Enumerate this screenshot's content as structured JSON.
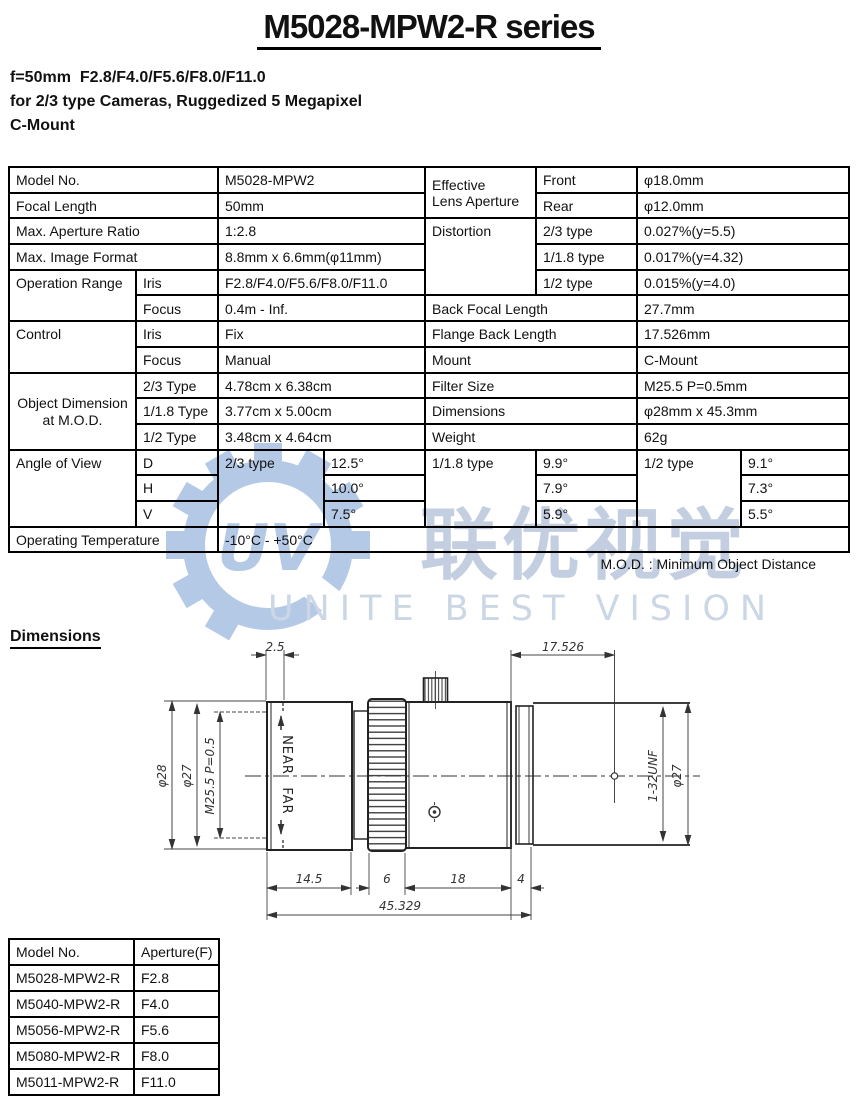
{
  "title": "M5028-MPW2-R series",
  "header": {
    "line1": "f=50mm  F2.8/F4.0/F5.6/F8.0/F11.0",
    "line2": "for 2/3 type Cameras, Ruggedized 5 Megapixel",
    "line3": "C-Mount"
  },
  "spec": {
    "model_no_label": "Model No.",
    "model_no": "M5028-MPW2",
    "focal_length_label": "Focal Length",
    "focal_length": "50mm",
    "max_aperture_label": "Max. Aperture Ratio",
    "max_aperture": "1:2.8",
    "max_format_label": "Max. Image Format",
    "max_format": "8.8mm x 6.6mm(φ11mm)",
    "operation_range_label": "Operation Range",
    "iris_label": "Iris",
    "iris_range": "F2.8/F4.0/F5.6/F8.0/F11.0",
    "focus_label": "Focus",
    "focus_range": "0.4m - Inf.",
    "control_label": "Control",
    "control_iris_label": "Iris",
    "control_iris": "Fix",
    "control_focus_label": "Focus",
    "control_focus": "Manual",
    "object_dim_label_1": "Object Dimension",
    "object_dim_label_2": "at M.O.D.",
    "od_23_label": "2/3 Type",
    "od_23": "4.78cm x 6.38cm",
    "od_118_label": "1/1.8 Type",
    "od_118": "3.77cm x 5.00cm",
    "od_12_label": "1/2 Type",
    "od_12": "3.48cm x 4.64cm",
    "effective_label_1": "Effective",
    "effective_label_2": "Lens Aperture",
    "front_label": "Front",
    "front": "φ18.0mm",
    "rear_label": "Rear",
    "rear": "φ12.0mm",
    "distortion_label": "Distortion",
    "dist_23_label": "2/3 type",
    "dist_23": "0.027%(y=5.5)",
    "dist_118_label": "1/1.8 type",
    "dist_118": "0.017%(y=4.32)",
    "dist_12_label": "1/2 type",
    "dist_12": "0.015%(y=4.0)",
    "bfl_label": "Back Focal Length",
    "bfl": "27.7mm",
    "fbl_label": "Flange Back Length",
    "fbl": "17.526mm",
    "mount_label": "Mount",
    "mount": "C-Mount",
    "filter_label": "Filter Size",
    "filter": "M25.5 P=0.5mm",
    "dims_label": "Dimensions",
    "dims": "φ28mm x 45.3mm",
    "weight_label": "Weight",
    "weight": "62g",
    "aov_label": "Angle of View",
    "d_label": "D",
    "h_label": "H",
    "v_label": "V",
    "aov_23_label": "2/3 type",
    "aov_23": [
      "12.5°",
      "10.0°",
      "7.5°"
    ],
    "aov_118_label": "1/1.8 type",
    "aov_118": [
      "9.9°",
      "7.9°",
      "5.9°"
    ],
    "aov_12_label": "1/2 type",
    "aov_12": [
      "9.1°",
      "7.3°",
      "5.5°"
    ],
    "op_temp_label": "Operating Temperature",
    "op_temp": "-10°C - +50°C"
  },
  "mod_note": "M.O.D. : Minimum Object Distance",
  "dimensions_heading": "Dimensions",
  "drawing": {
    "labels": {
      "dim_2_5": "2.5",
      "dim_17_526": "17.526",
      "phi28": "φ28",
      "phi27_left": "φ27",
      "m25": "M25.5 P=0.5",
      "near": "NEAR",
      "far": "FAR",
      "unf": "1-32UNF",
      "phi27_right": "φ27",
      "dim_14_5": "14.5",
      "dim_6": "6",
      "dim_18": "18",
      "dim_4": "4",
      "dim_total": "45.329"
    }
  },
  "model_table": {
    "headers": [
      "Model No.",
      "Aperture(F)"
    ],
    "rows": [
      [
        "M5028-MPW2-R",
        "F2.8"
      ],
      [
        "M5040-MPW2-R",
        "F4.0"
      ],
      [
        "M5056-MPW2-R",
        "F5.6"
      ],
      [
        "M5080-MPW2-R",
        "F8.0"
      ],
      [
        "M5011-MPW2-R",
        "F11.0"
      ]
    ]
  },
  "watermark": {
    "cn": "联优视觉",
    "en": "UNITE BEST VISION",
    "logo_color": "#b4c9e6",
    "cn_color": "#c3cfe0",
    "en_color": "#ccd7e5"
  }
}
